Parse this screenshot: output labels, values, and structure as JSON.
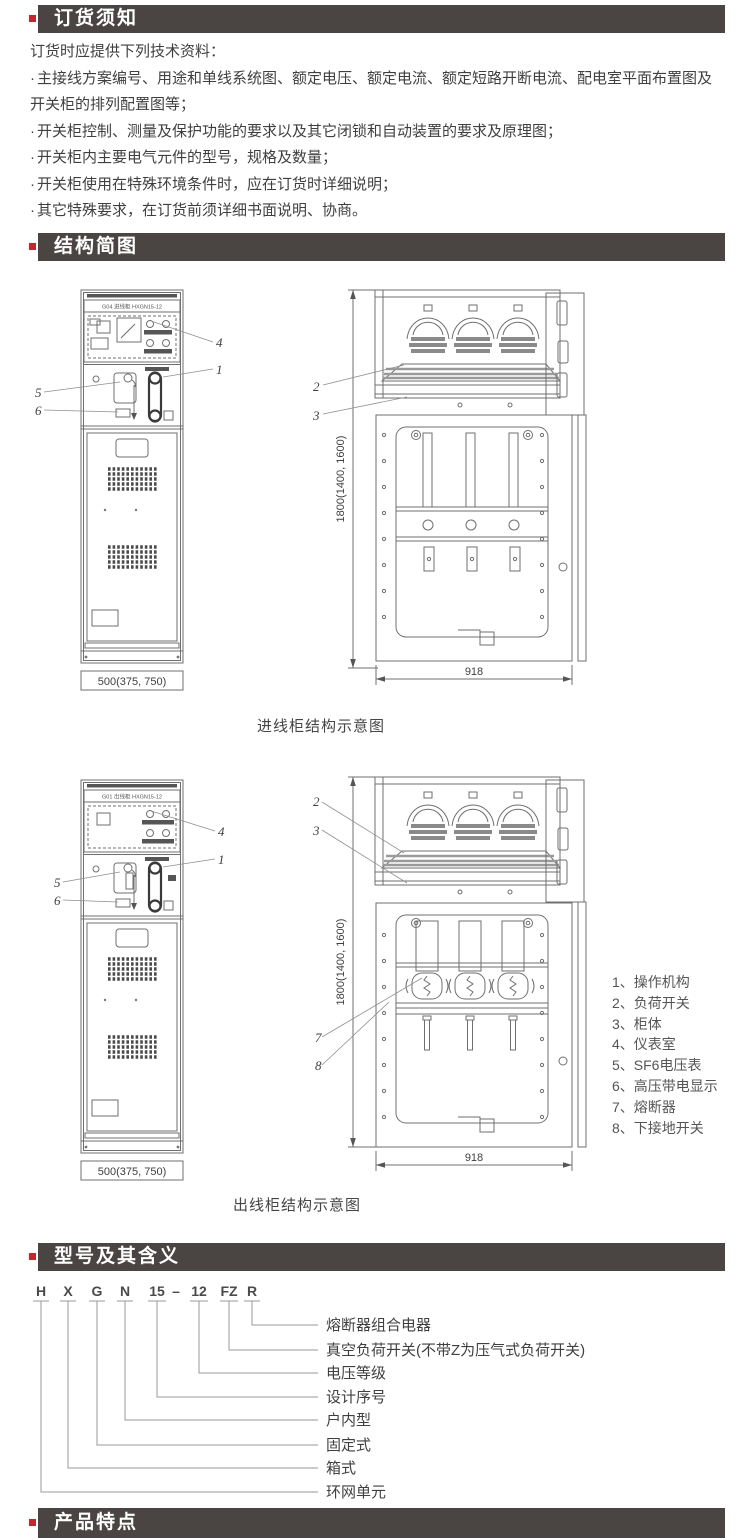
{
  "theme": {
    "accent_red": "#c1272d",
    "header_bg": "#4a4542",
    "header_fg": "#ffffff",
    "line_gray": "#6f6f6f"
  },
  "ordering": {
    "title": "订货须知",
    "intro": "订货时应提供下列技术资料：",
    "bullet_char": "·",
    "bullets": [
      "主接线方案编号、用途和单线系统图、额定电压、额定电流、额定短路开断电流、配电室平面布置图及开关柜的排列配置图等；",
      "开关柜控制、测量及保护功能的要求以及其它闭锁和自动装置的要求及原理图；",
      "开关柜内主要电气元件的型号，规格及数量；",
      "开关柜使用在特殊环境条件时，应在订货时详细说明；",
      "其它特殊要求，在订货前须详细书面说明、协商。"
    ]
  },
  "structure": {
    "title": "结构简图",
    "callout_labels": [
      "1",
      "2",
      "3",
      "4",
      "5",
      "6",
      "7",
      "8"
    ],
    "incoming": {
      "caption": "进线柜结构示意图",
      "panel_label": "G04  进线柜  HXGN15-12",
      "width_dim": "500(375, 750)",
      "depth_dim": "918",
      "height_dim": "1800(1400, 1600)"
    },
    "outgoing": {
      "caption": "出线柜结构示意图",
      "panel_label": "G01  出线柜  HXGN15-12",
      "width_dim": "500(375, 750)",
      "depth_dim": "918",
      "height_dim": "1800(1400, 1600)"
    },
    "legend": [
      "1、操作机构",
      "2、负荷开关",
      "3、柜体",
      "4、仪表室",
      "5、SF6电压表",
      "6、高压带电显示",
      "7、熔断器",
      "8、下接地开关"
    ]
  },
  "model": {
    "title": "型号及其含义",
    "code": [
      "H",
      "X",
      "G",
      "N",
      "15",
      "–",
      "12",
      "FZ",
      "R"
    ],
    "meanings": [
      "熔断器组合电器",
      "真空负荷开关(不带Z为压气式负荷开关)",
      "电压等级",
      "设计序号",
      "户内型",
      "固定式",
      "箱式",
      "环网单元"
    ]
  },
  "features": {
    "title": "产品特点"
  }
}
